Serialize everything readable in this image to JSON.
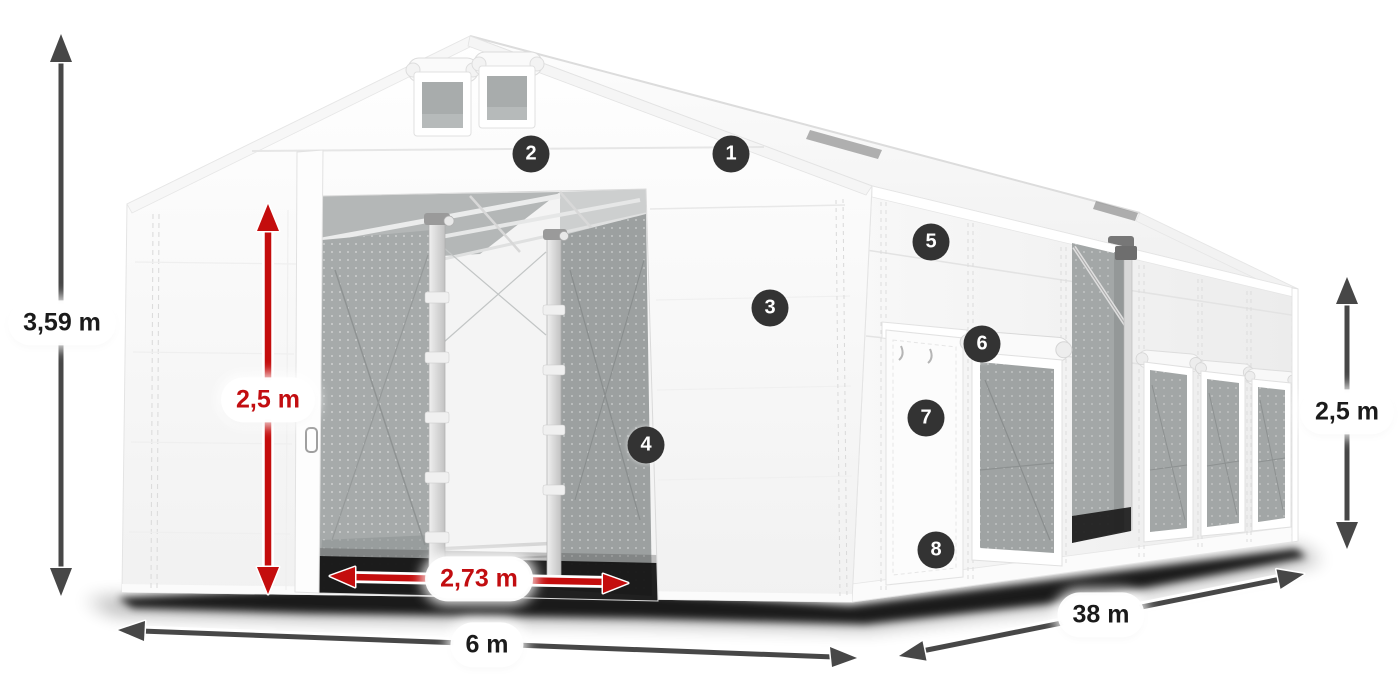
{
  "product_diagram": {
    "dimensions": {
      "total_height": "3,59 m",
      "entrance_height": "2,5 m",
      "entrance_width": "2,73 m",
      "tent_width": "6 m",
      "tent_length": "38 m",
      "side_wall_height": "2,5 m"
    },
    "markers": [
      "1",
      "2",
      "3",
      "4",
      "5",
      "6",
      "7",
      "8"
    ],
    "colors": {
      "dimension_arrow_dark": "#474747",
      "dimension_arrow_red": "#c40d0d",
      "dimension_text_red": "#c20d10",
      "marker_background": "#333333",
      "marker_text": "#ffffff",
      "label_background": "#ffffff"
    }
  }
}
